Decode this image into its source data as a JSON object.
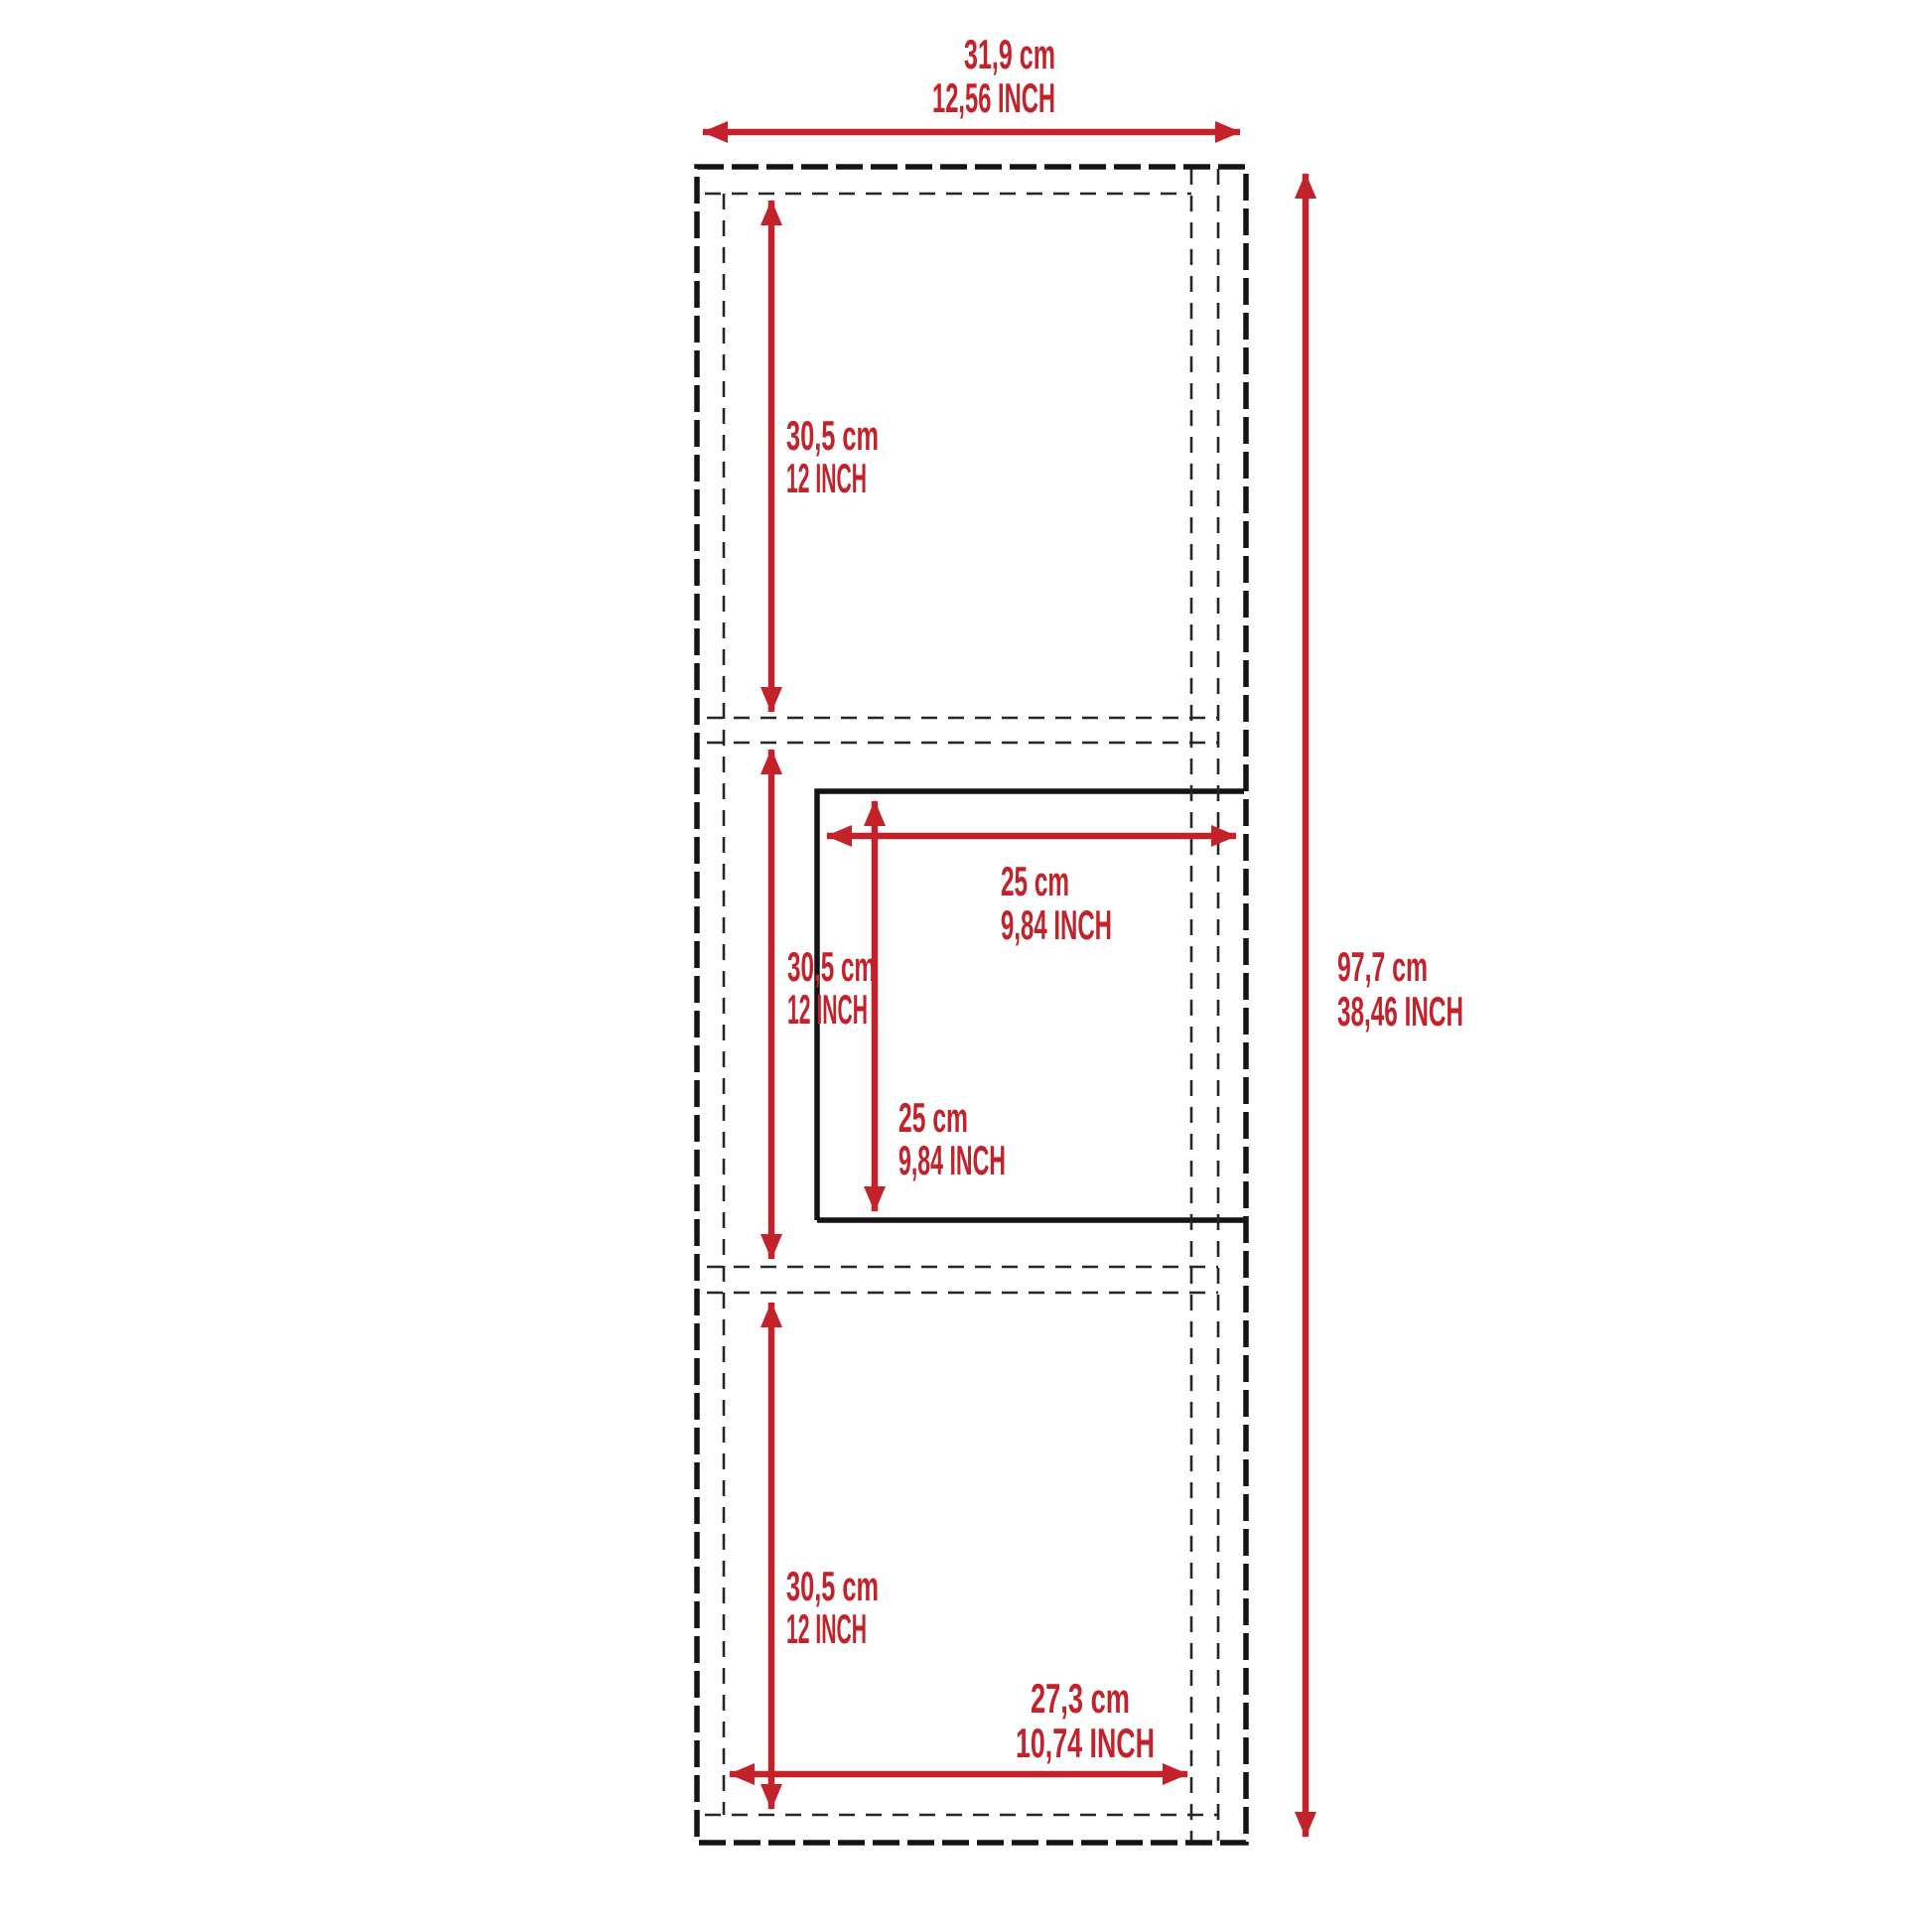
{
  "diagram": {
    "kind": "cabinet-dimension-drawing",
    "colors": {
      "dimension_red": "#C3222B",
      "outline_black": "#141414",
      "dashed_gray": "#262626",
      "background": "#ffffff"
    },
    "dims": {
      "overall_width": {
        "cm": "31,9 cm",
        "inch": "12,56 INCH"
      },
      "overall_height": {
        "cm": "97,7 cm",
        "inch": "38,46 INCH"
      },
      "top_section_height": {
        "cm": "30,5 cm",
        "inch": "12 INCH"
      },
      "middle_section_height": {
        "cm": "30,5 cm",
        "inch": "12 INCH"
      },
      "bottom_section_height": {
        "cm": "30,5 cm",
        "inch": "12 INCH"
      },
      "drawer_width": {
        "cm": "25 cm",
        "inch": "9,84 INCH"
      },
      "drawer_height": {
        "cm": "25 cm",
        "inch": "9,84 INCH"
      },
      "interior_width": {
        "cm": "27,3 cm",
        "inch": "10,74 INCH"
      }
    }
  }
}
